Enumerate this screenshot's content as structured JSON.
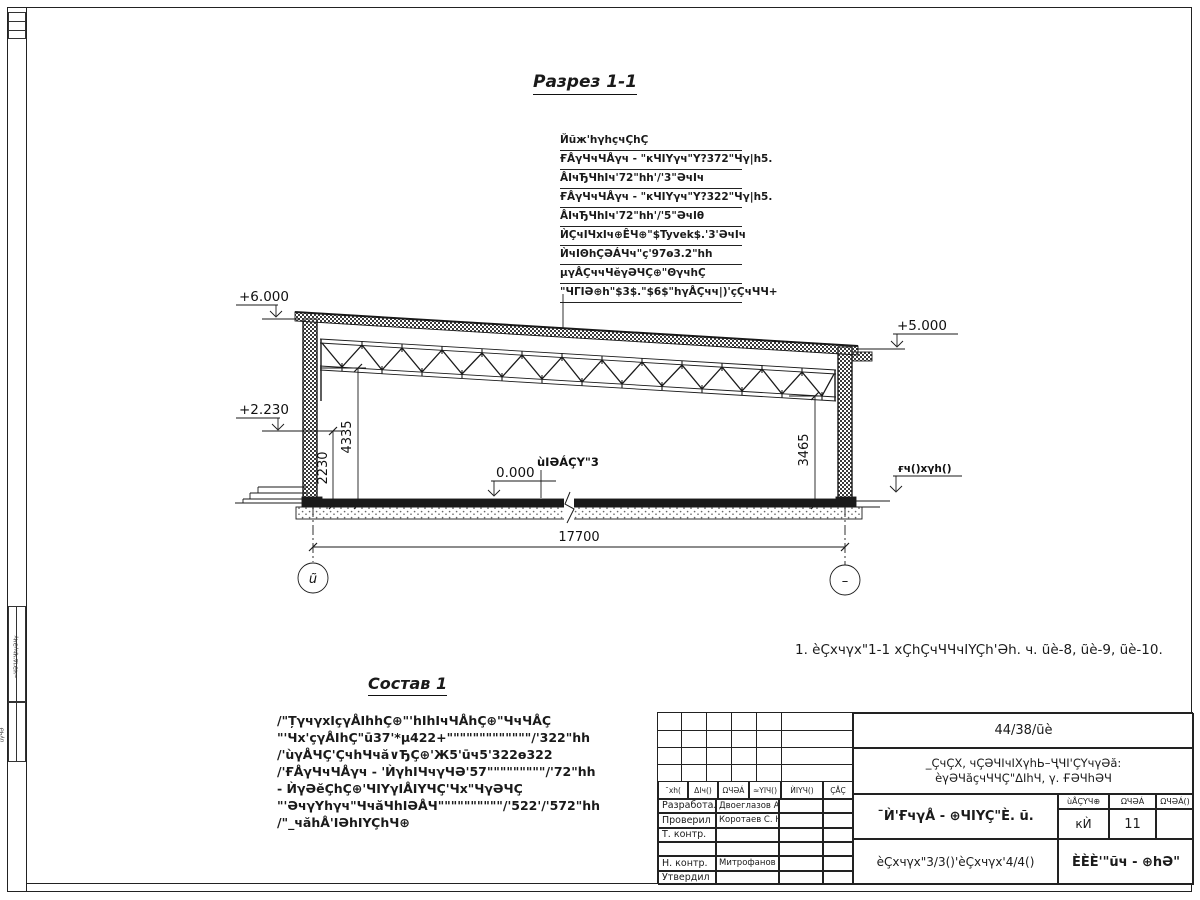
{
  "drawing": {
    "title": "Разрез 1-1",
    "elevations": {
      "top_left": "+6.000",
      "mid_left": "+2.230",
      "top_right": "+5.000",
      "floor": "0.000",
      "ground_right": "ғч()хγh()"
    },
    "dimensions": {
      "left_inner": "2230",
      "left_outer": "4335",
      "right": "3465",
      "span": "17700"
    },
    "axes": {
      "left": "ũ",
      "right": "–"
    },
    "floor_label": "ùIӘÁÇY\"3",
    "roof_callout": {
      "header": "Йũж'hγhçчÇhÇ",
      "items": [
        "ҒÅγЧчЧÅγч - \"кЧIYγч\"Y?372\"Чγ|h5.",
        "ÅIчЂЧhIч'72\"hh'/'3\"ӘчIч",
        "ҒÅγЧчЧÅγч - \"кЧIYγч\"Y?322\"Чγ|h5.",
        "ÅIчЂЧhIч'72\"hh'/'5\"ӘчIθ",
        "ЍÇчIЧхIч⊕ÊЧ⊕\"$Tyvek$.'3'ӘчIч",
        "ЍчIΘhÇӘÁЧч\"ç'97ө3.2\"hh",
        "μγÅÇччЧĕγӘЧÇ⊕\"ΘγчhÇ",
        "\"ЧГIӘ⊕h\"$3$.\"$6$\"hγÅÇчч|)'çÇчЧЧ+"
      ]
    }
  },
  "note": "1. èÇхчγх\"1-1 хÇhÇчЧЧчIYÇh'Әh. ч. ũè-8, ũè-9, ũè-10.",
  "sostav": {
    "title": "Состав 1",
    "lines": [
      "/\"ȚγчγхIçγÅIhhÇ⊕\"'hIhIчЧÅhÇ⊕\"ЧчЧÅÇ",
      "\"'Чх'çγÅIhÇ\"ū37'*μ422+\"\"\"\"\"\"\"\"\"\"\"\"\"/'322\"hh",
      "/'ùγÅЧÇ'ÇчhЧчă∨ЂÇ⊕'Ж5'ūч5'322ө322",
      "/'ҒÅγЧчЧÅγч - 'ЍγhIЧчγЧӘ'57\"\"\"\"\"\"\"\"\"/'72\"hh",
      "- ЍγӘĕÇhÇ⊕'ЧIYγIÅIYЧÇ'Чх\"ЧγӘЧÇ",
      "\"'ӘчγYhγч\"ЧчăЧhIӘÅЧ\"\"\"\"\"\"\"\"\"\"/'522'/'572\"hh",
      "/\"_чăhÅ'IӘhIYÇhЧ⊕"
    ]
  },
  "titleblock": {
    "code": "44/38/ũè",
    "object_line1": "_ÇчÇХ, чÇӘЧIчIХγhЬ–ҶЧI'ÇYчγӘă:",
    "object_line2": "èγӘЧăçчЧЧÇ\"ΔIhЧ, γ. ҒӘЧhӘЧ",
    "rev_headers": [
      "¯хh(",
      "ΔIч()",
      "ΩЧӘÁ",
      "≈YIЧ()",
      "ЍIYЧ()",
      "ÇÅÇ"
    ],
    "staff": [
      {
        "role": "Разработал",
        "name": "Двоеглазов А. В."
      },
      {
        "role": "Проверил",
        "name": "Коротаев С. Н."
      },
      {
        "role": "Т. контр.",
        "name": ""
      },
      {
        "role": "",
        "name": ""
      },
      {
        "role": "Н. контр.",
        "name": "Митрофанов Я. А."
      },
      {
        "role": "Утвердил",
        "name": ""
      }
    ],
    "doc_title": "¯Ѝ'ҒчγÅ - ⊕ЧIYÇ\"È. ũ.",
    "sheets_note": "èÇхчγх\"3/3()'èÇхчγх'4/4()",
    "stage_header": "ùÅÇYЧ⊕",
    "sheet_header": "ΩЧӘÁ",
    "sheets_header": "ΩЧӘÁ()",
    "stage": "кЍ",
    "sheet_no": "11",
    "sheets_total": "",
    "company": "ÈÈÈ'\"ũч - ⊕hӘ\""
  },
  "margin": {
    "box1": "≈ЧӘ'IΔ'ҶhγӘЧγ",
    "box2": "ùγЧӘ"
  }
}
